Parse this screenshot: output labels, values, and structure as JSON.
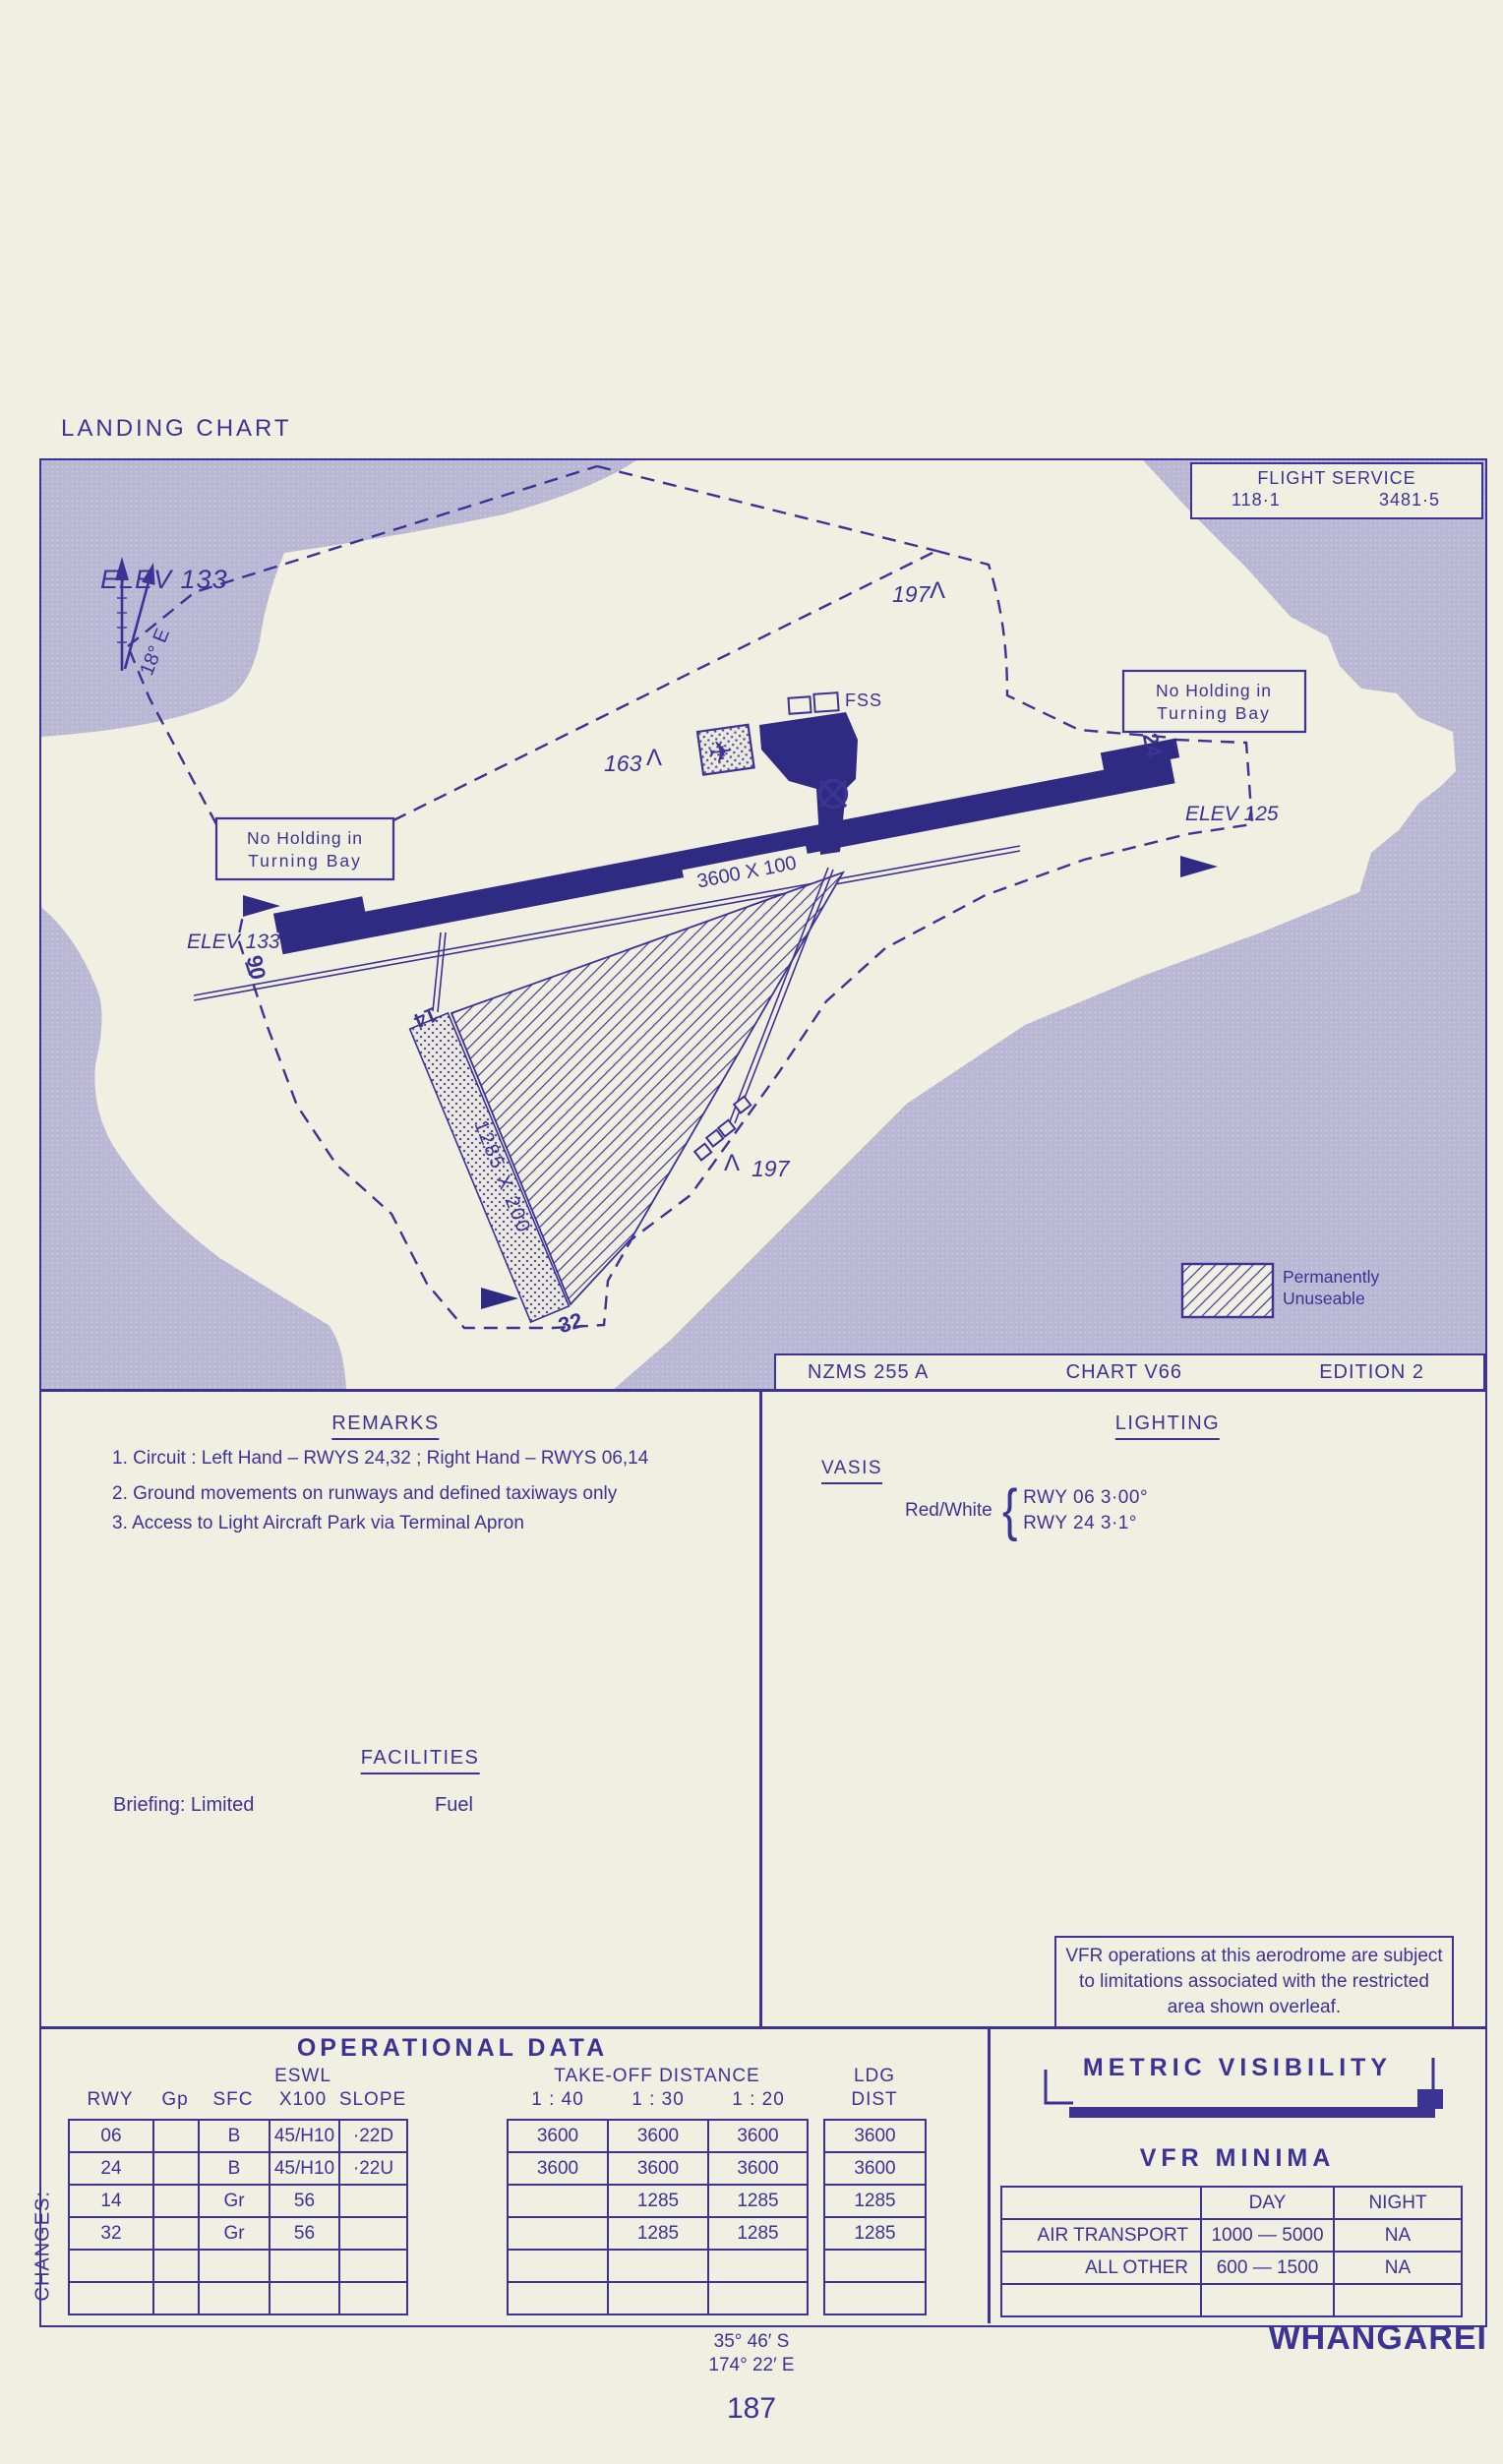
{
  "page": {
    "title": "LANDING CHART",
    "changes_label": "CHANGES:",
    "page_number": "187",
    "airport_name": "WHANGAREI",
    "coords_lat": "35° 46′ S",
    "coords_lon": "174° 22′ E"
  },
  "colors": {
    "ink": "#3c3394",
    "runway_fill": "#2f2a82",
    "water": "#b9b7d3",
    "paper": "#f0efe1"
  },
  "flight_service": {
    "title": "FLIGHT SERVICE",
    "vhf_freq": "118·1",
    "hf_freq": "3481·5"
  },
  "map": {
    "elev_main": "ELEV 133",
    "variation": "18° E",
    "obstruction_top": "197",
    "obstruction_mid": "163",
    "obstruction_low": "197",
    "fss_label": "FSS",
    "no_holding_line1": "No Holding in",
    "no_holding_line2": "Turning Bay",
    "main_runway_dims": "3600 X 100",
    "grass_runway_dims": "1285 X 200",
    "elev_rwy06": "ELEV 133",
    "elev_rwy24": "ELEV 125",
    "rwy_06": "06",
    "rwy_24": "24",
    "rwy_14": "14",
    "rwy_32": "32",
    "legend_line1": "Permanently",
    "legend_line2": "Unuseable",
    "series": "NZMS 255 A",
    "chart_no": "CHART V66",
    "edition": "EDITION 2"
  },
  "remarks": {
    "title": "REMARKS",
    "item1": "1. Circuit : Left Hand – RWYS 24,32 ;  Right  Hand – RWYS 06,14",
    "item2": "2. Ground  movements  on runways  and  defined  taxiways  only",
    "item3": "3. Access  to  Light  Aircraft Park  via Terminal  Apron"
  },
  "lighting": {
    "title": "LIGHTING",
    "vasis_label": "VASIS",
    "vasis_color": "Red/White",
    "vasis_line1": "RWY 06  3·00°",
    "vasis_line2": "RWY 24  3·1°"
  },
  "facilities": {
    "title": "FACILITIES",
    "briefing": "Briefing: Limited",
    "fuel": "Fuel"
  },
  "vfr_note": "VFR operations at this aerodrome are subject to limitations associated with the restricted area shown overleaf.",
  "operational": {
    "title": "OPERATIONAL  DATA",
    "col_rwy": "RWY",
    "col_gp": "Gp",
    "col_sfc": "SFC",
    "col_eswl_1": "ESWL",
    "col_eswl_2": "X100",
    "col_slope": "SLOPE",
    "col_tod": "TAKE-OFF DISTANCE",
    "tod_cols": [
      "1 : 40",
      "1 : 30",
      "1 : 20"
    ],
    "col_ldg_1": "LDG",
    "col_ldg_2": "DIST",
    "rows": [
      [
        "06",
        "",
        "B",
        "45/H10",
        "·22D",
        "3600",
        "3600",
        "3600",
        "3600"
      ],
      [
        "24",
        "",
        "B",
        "45/H10",
        "·22U",
        "3600",
        "3600",
        "3600",
        "3600"
      ],
      [
        "14",
        "",
        "Gr",
        "56",
        "",
        "",
        "1285",
        "1285",
        "1285"
      ],
      [
        "32",
        "",
        "Gr",
        "56",
        "",
        "",
        "1285",
        "1285",
        "1285"
      ],
      [
        "",
        "",
        "",
        "",
        "",
        "",
        "",
        "",
        ""
      ],
      [
        "",
        "",
        "",
        "",
        "",
        "",
        "",
        "",
        ""
      ]
    ]
  },
  "metric_visibility": {
    "title": "METRIC  VISIBILITY",
    "subtitle": "VFR  MINIMA",
    "col_day": "DAY",
    "col_night": "NIGHT",
    "rows": [
      [
        "AIR TRANSPORT",
        "1000 — 5000",
        "NA"
      ],
      [
        "ALL OTHER",
        "600 — 1500",
        "NA"
      ],
      [
        "",
        "",
        ""
      ]
    ]
  }
}
